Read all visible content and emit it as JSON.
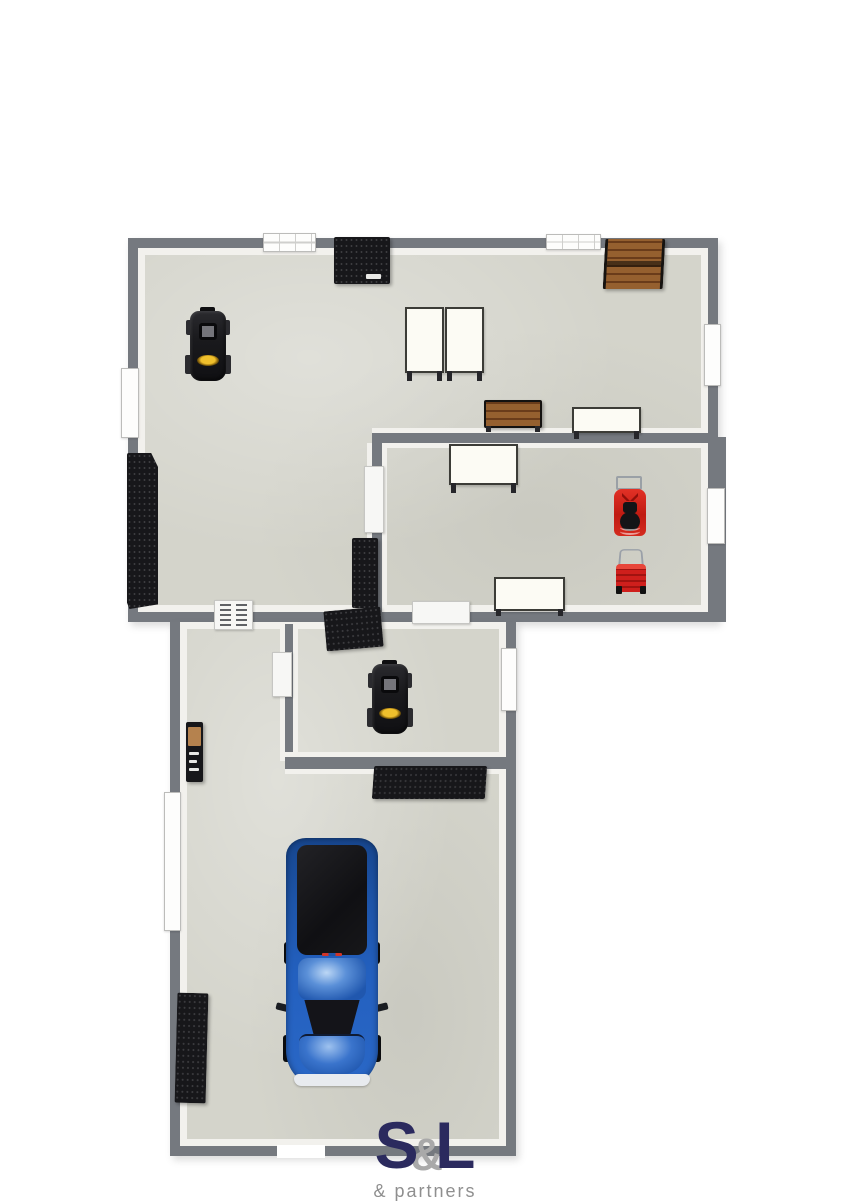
{
  "logo": {
    "s": "S",
    "amp": "&",
    "l": "L",
    "tagline": "& partners"
  },
  "colors": {
    "background": "#ffffff",
    "wall": "#75797f",
    "wall_inner": "#f2f1ed",
    "floor": "#d4d4cb",
    "furniture_black": "#17171a",
    "wood": "#8d5a31",
    "table_white": "#fcfbf4",
    "mower_red": "#d0211c",
    "truck_blue": "#2057ae",
    "accent_yellow": "#e8b21f",
    "logo_navy": "#2b2a5e",
    "logo_amp_gray": "#a9a9a9",
    "tagline_gray": "#8f8f8f"
  },
  "inventory": {
    "rooms": [
      "workshop",
      "side room",
      "middle room",
      "garage"
    ],
    "items": [
      "wall tool rack (top wall)",
      "wood storage shelf (top right)",
      "lawn tractor (workshop)",
      "white worktable pair (workshop)",
      "wood bench",
      "white worktable (right of bench)",
      "white worktable (side room top)",
      "riding mower (red)",
      "push mower (red)",
      "white worktable (side room bottom)",
      "tall storage rack (left wall)",
      "storage rack (by divider wall)",
      "tilted storage rack (middle wall)",
      "tool cabinet (garage left wall)",
      "lawn tractor (middle room)",
      "storage rack (below middle room)",
      "storage rack (garage left wall)",
      "blue pickup truck"
    ]
  }
}
